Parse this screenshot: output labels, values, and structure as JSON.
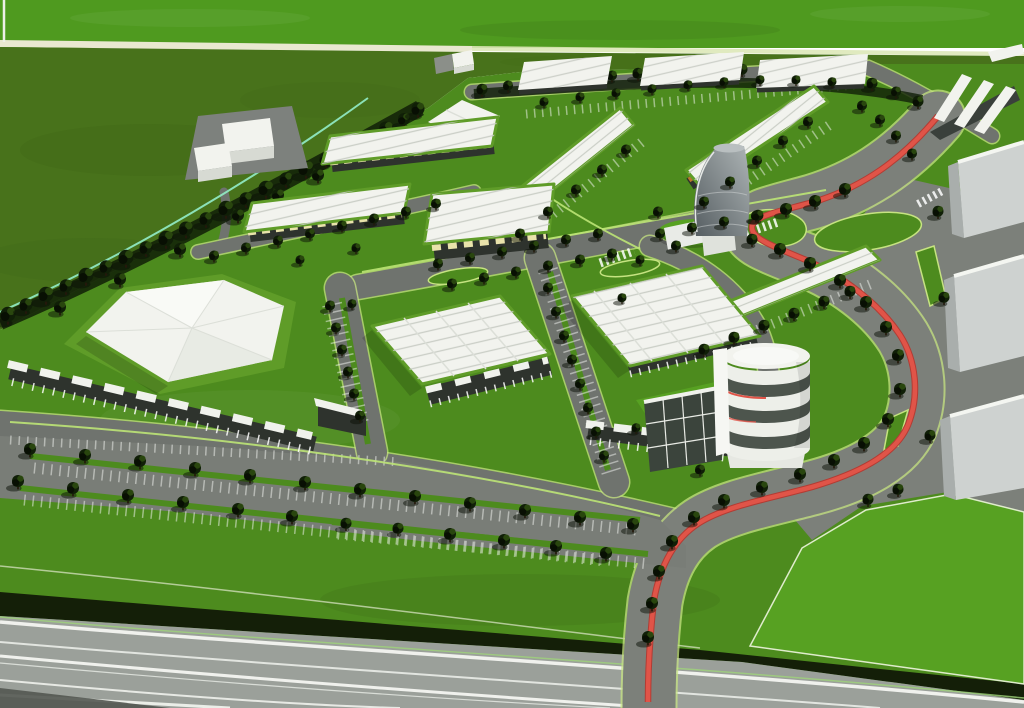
{
  "scene": {
    "subject": "Aerial 3D architectural rendering of a business park masterplan",
    "style": "computer generated architectural visualization, bird's eye perspective",
    "features": [
      "open green fields with boundary footpath",
      "diagonal perimeter tree belt",
      "rows of white-roofed industrial units with green parapet gardens",
      "orange loading-door accents on long warehouse rows",
      "large warehouses with white vaulted roofs and glass storefront canopies",
      "white tent-roof pavilion on a lawn berm",
      "curved grey landmark tower",
      "white cylindrical drum office building with band windows",
      "tree-lined avenue with red cycle lane ribbon",
      "large surface parking lot with tree rows and white stall stripes",
      "green median islands and light-green kerb lines",
      "dark hedge band and striped highway along the bottom edge"
    ]
  },
  "palette": {
    "field-bright": "#4f9a1f",
    "field-olive": "#48721b",
    "field-dark": "#3c6315",
    "lawn": "#4d8b1e",
    "lawn-bright": "#57a122",
    "berm": "#5f9c28",
    "road": "#6f736e",
    "road-light": "#7c807a",
    "parking": "#797d77",
    "kerb": "#c6e381",
    "path-line": "#bce475",
    "teal": "#8fe7c1",
    "cream": "#e9e8d0",
    "hedge": "#141f08",
    "highway": "#9ba09a",
    "stripe": "#f4f6f1",
    "roof-white": "#f2f3ee",
    "roof-shade": "#dcdfd8",
    "rib": "#c6cac2",
    "facade": "#2e332d",
    "canopy": "#f0f2ec",
    "canopy-yellow": "#e9e3ab",
    "door-orange": "#bf7a2c",
    "glass": "#3b443c",
    "red": "#e05448",
    "red-dark": "#b23c34",
    "concrete": "#ced2d0",
    "concrete-shade": "#a9aeac",
    "tower-dark": "#555d61",
    "tower-light": "#adb4b5",
    "tree-dark": "#101f07",
    "tree-mid": "#2c4a10"
  },
  "trees": {
    "belt": [
      [
        8,
        318,
        1.5
      ],
      [
        26,
        308,
        1.3
      ],
      [
        46,
        298,
        1.5
      ],
      [
        66,
        289,
        1.3
      ],
      [
        86,
        279,
        1.5
      ],
      [
        106,
        270,
        1.3
      ],
      [
        126,
        261,
        1.5
      ],
      [
        146,
        251,
        1.3
      ],
      [
        166,
        242,
        1.5
      ],
      [
        186,
        232,
        1.4
      ],
      [
        206,
        222,
        1.3
      ],
      [
        226,
        212,
        1.5
      ],
      [
        246,
        202,
        1.3
      ],
      [
        266,
        192,
        1.5
      ],
      [
        286,
        182,
        1.3
      ],
      [
        306,
        172,
        1.5
      ],
      [
        326,
        162,
        1.3
      ],
      [
        346,
        152,
        1.4
      ],
      [
        366,
        142,
        1.3
      ],
      [
        386,
        132,
        1.4
      ],
      [
        404,
        122,
        1.2
      ],
      [
        418,
        112,
        1.3
      ],
      [
        238,
        218,
        1.2
      ],
      [
        278,
        198,
        1.2
      ],
      [
        318,
        178,
        1.2
      ],
      [
        358,
        158,
        1.2
      ],
      [
        396,
        138,
        1.1
      ],
      [
        60,
        310,
        1.2
      ],
      [
        120,
        282,
        1.2
      ],
      [
        180,
        252,
        1.2
      ]
    ],
    "topRow": [
      [
        482,
        92,
        1.1
      ],
      [
        508,
        88,
        1.0
      ],
      [
        534,
        85,
        1.1
      ],
      [
        560,
        82,
        1.0
      ],
      [
        586,
        80,
        1.1
      ],
      [
        612,
        78,
        1.0
      ],
      [
        638,
        76,
        1.1
      ],
      [
        664,
        74,
        1.0
      ],
      [
        690,
        73,
        1.1
      ],
      [
        716,
        72,
        1.0
      ],
      [
        742,
        72,
        1.1
      ],
      [
        768,
        73,
        1.0
      ],
      [
        794,
        74,
        1.1
      ],
      [
        820,
        76,
        1.0
      ],
      [
        846,
        80,
        1.1
      ],
      [
        872,
        86,
        1.1
      ],
      [
        896,
        94,
        1.0
      ],
      [
        918,
        104,
        1.1
      ]
    ],
    "north": [
      [
        214,
        258,
        1.0
      ],
      [
        246,
        250,
        1.0
      ],
      [
        278,
        243,
        1.0
      ],
      [
        310,
        236,
        1.0
      ],
      [
        342,
        228,
        1.0
      ],
      [
        374,
        221,
        1.0
      ],
      [
        406,
        214,
        1.0
      ],
      [
        436,
        206,
        1.0
      ],
      [
        300,
        262,
        0.9
      ],
      [
        356,
        250,
        0.9
      ]
    ],
    "strips": [
      [
        520,
        236,
        1.0
      ],
      [
        548,
        214,
        1.0
      ],
      [
        576,
        192,
        1.0
      ],
      [
        602,
        172,
        1.0
      ],
      [
        626,
        152,
        1.0
      ],
      [
        704,
        204,
        1.0
      ],
      [
        730,
        184,
        1.0
      ],
      [
        757,
        163,
        1.0
      ],
      [
        783,
        143,
        1.0
      ],
      [
        808,
        124,
        1.0
      ],
      [
        544,
        104,
        0.9
      ],
      [
        580,
        99,
        0.9
      ],
      [
        616,
        95,
        0.9
      ],
      [
        652,
        91,
        0.9
      ],
      [
        688,
        87,
        0.9
      ],
      [
        724,
        84,
        0.9
      ],
      [
        760,
        82,
        0.9
      ],
      [
        796,
        82,
        0.9
      ],
      [
        832,
        84,
        0.9
      ],
      [
        704,
        352,
        1.1
      ],
      [
        734,
        340,
        1.1
      ],
      [
        764,
        328,
        1.1
      ],
      [
        794,
        316,
        1.1
      ],
      [
        824,
        304,
        1.1
      ],
      [
        850,
        294,
        1.1
      ]
    ],
    "boulevard": [
      [
        438,
        266,
        1.0
      ],
      [
        470,
        260,
        1.0
      ],
      [
        502,
        254,
        1.0
      ],
      [
        534,
        248,
        1.0
      ],
      [
        566,
        242,
        1.0
      ],
      [
        598,
        236,
        1.0
      ],
      [
        452,
        286,
        1.0
      ],
      [
        484,
        280,
        1.0
      ],
      [
        516,
        274,
        1.0
      ],
      [
        548,
        268,
        1.0
      ],
      [
        580,
        262,
        1.0
      ],
      [
        612,
        256,
        1.0
      ],
      [
        660,
        236,
        1.0
      ],
      [
        692,
        230,
        1.0
      ],
      [
        724,
        224,
        1.0
      ],
      [
        756,
        218,
        1.0
      ]
    ],
    "street1": [
      [
        330,
        308,
        1.0
      ],
      [
        336,
        330,
        1.0
      ],
      [
        342,
        352,
        1.0
      ],
      [
        348,
        374,
        1.0
      ],
      [
        354,
        396,
        1.0
      ],
      [
        360,
        418,
        1.0
      ],
      [
        352,
        306,
        0.9
      ]
    ],
    "street2": [
      [
        548,
        290,
        1.0
      ],
      [
        556,
        314,
        1.0
      ],
      [
        564,
        338,
        1.0
      ],
      [
        572,
        362,
        1.0
      ],
      [
        580,
        386,
        1.0
      ],
      [
        588,
        410,
        1.0
      ],
      [
        596,
        434,
        1.0
      ],
      [
        604,
        458,
        1.0
      ]
    ],
    "avenue": [
      [
        845,
        192,
        1.2
      ],
      [
        815,
        204,
        1.2
      ],
      [
        786,
        212,
        1.2
      ],
      [
        758,
        218,
        1.1
      ],
      [
        752,
        242,
        1.1
      ],
      [
        780,
        252,
        1.2
      ],
      [
        810,
        266,
        1.2
      ],
      [
        840,
        283,
        1.2
      ],
      [
        866,
        305,
        1.2
      ],
      [
        886,
        330,
        1.2
      ],
      [
        898,
        358,
        1.2
      ],
      [
        900,
        392,
        1.2
      ],
      [
        888,
        422,
        1.2
      ],
      [
        864,
        446,
        1.2
      ],
      [
        834,
        463,
        1.2
      ],
      [
        800,
        477,
        1.2
      ],
      [
        762,
        490,
        1.2
      ],
      [
        724,
        503,
        1.2
      ],
      [
        694,
        520,
        1.2
      ],
      [
        672,
        544,
        1.2
      ],
      [
        659,
        574,
        1.2
      ],
      [
        652,
        606,
        1.2
      ],
      [
        648,
        640,
        1.2
      ],
      [
        862,
        108,
        1.0
      ],
      [
        880,
        122,
        1.0
      ],
      [
        896,
        138,
        1.0
      ],
      [
        912,
        156,
        1.0
      ],
      [
        938,
        214,
        1.1
      ],
      [
        944,
        300,
        1.1
      ],
      [
        930,
        438,
        1.1
      ],
      [
        868,
        502,
        1.1
      ],
      [
        898,
        492,
        1.1
      ]
    ],
    "lot": [
      [
        30,
        452,
        1.2
      ],
      [
        85,
        458,
        1.2
      ],
      [
        140,
        464,
        1.2
      ],
      [
        195,
        471,
        1.2
      ],
      [
        250,
        478,
        1.2
      ],
      [
        305,
        485,
        1.2
      ],
      [
        360,
        492,
        1.2
      ],
      [
        415,
        499,
        1.2
      ],
      [
        470,
        506,
        1.2
      ],
      [
        525,
        513,
        1.2
      ],
      [
        580,
        520,
        1.2
      ],
      [
        633,
        527,
        1.2
      ],
      [
        18,
        484,
        1.2
      ],
      [
        73,
        491,
        1.2
      ],
      [
        128,
        498,
        1.2
      ],
      [
        183,
        505,
        1.2
      ],
      [
        238,
        512,
        1.2
      ],
      [
        292,
        519,
        1.2
      ],
      [
        346,
        526,
        1.1
      ],
      [
        398,
        531,
        1.1
      ],
      [
        450,
        537,
        1.2
      ],
      [
        504,
        543,
        1.2
      ],
      [
        556,
        549,
        1.2
      ],
      [
        606,
        556,
        1.2
      ]
    ],
    "misc": [
      [
        658,
        214,
        1.0
      ],
      [
        676,
        248,
        1.0
      ],
      [
        640,
        262,
        0.9
      ],
      [
        700,
        472,
        1.0
      ],
      [
        636,
        430,
        0.9
      ],
      [
        622,
        300,
        0.9
      ]
    ]
  }
}
